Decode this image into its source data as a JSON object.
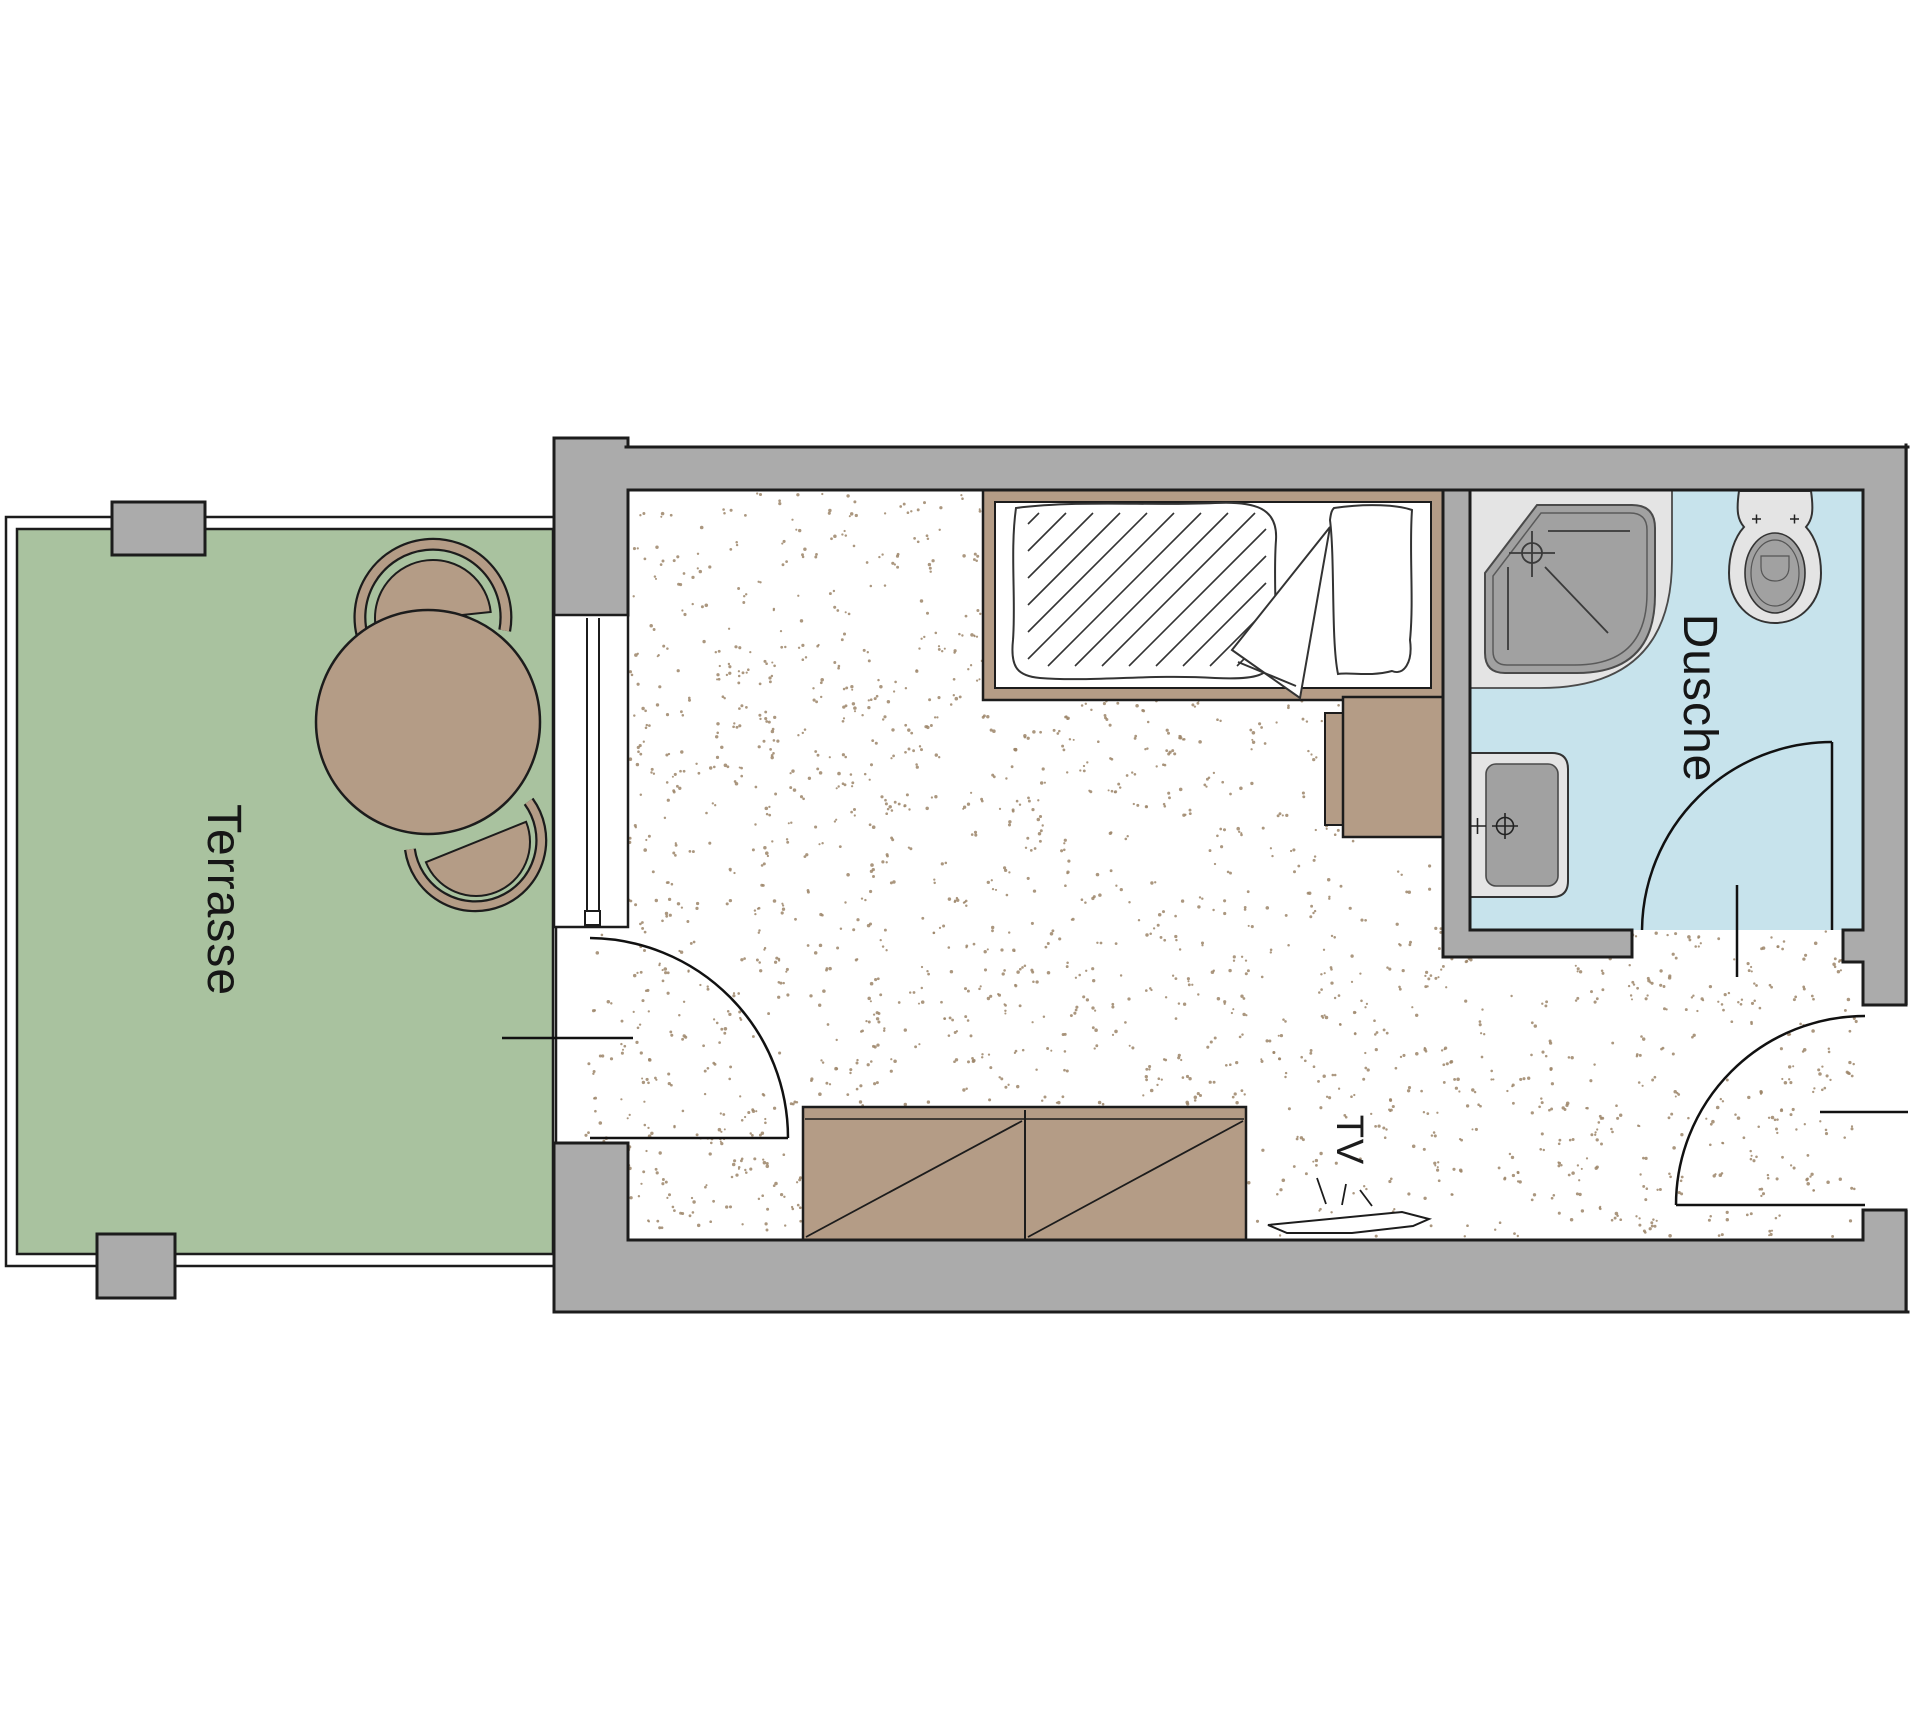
{
  "labels": {
    "terrace": "Terrasse",
    "shower_room": "Dusche",
    "tv": "TV"
  },
  "colors": {
    "background": "#ffffff",
    "wall_gray": "#ababab",
    "outline": "#1c1c1c",
    "terrace_green": "#a9c29f",
    "furniture_tan": "#b49c86",
    "bathroom_blue": "#c7e3ec",
    "fixture_light": "#e4e4e4",
    "fixture_dark": "#a1a1a1",
    "floor_white": "#ffffff",
    "floor_speckle": "#9c8569",
    "linen_white": "#ffffff"
  },
  "rooms": [
    {
      "id": "terrace",
      "label": "Terrasse",
      "floor": "green",
      "furniture": [
        "round-table",
        "chair",
        "chair"
      ]
    },
    {
      "id": "bedroom",
      "label": "",
      "floor": "speckled",
      "furniture": [
        "single-bed",
        "wardrobe",
        "desk",
        "desk-chair",
        "tv"
      ]
    },
    {
      "id": "shower-room",
      "label": "Dusche",
      "floor": "blue-tile",
      "furniture": [
        "corner-shower",
        "toilet",
        "washbasin"
      ]
    }
  ],
  "doors": [
    {
      "id": "terrace-door",
      "type": "swing"
    },
    {
      "id": "bathroom-door",
      "type": "swing"
    },
    {
      "id": "entrance-door",
      "type": "swing"
    }
  ]
}
